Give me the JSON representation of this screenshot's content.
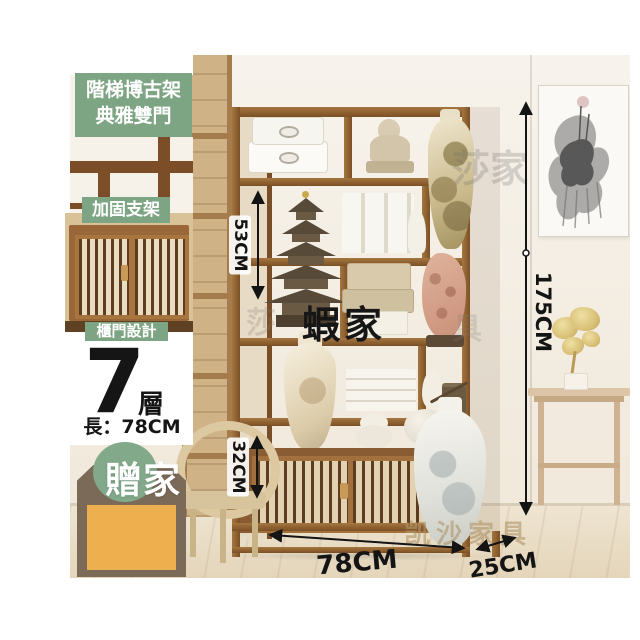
{
  "badges": {
    "title_line1": "階梯博古架",
    "title_line2": "典雅雙門",
    "feature_top": "加固支架",
    "feature_bottom": "櫃門設計",
    "tier_count": "7",
    "tier_unit": "層",
    "length_label": "長：78CM",
    "gift_text": "贈家"
  },
  "dimensions": {
    "upper_height": "53CM",
    "cabinet_height": "32CM",
    "total_height": "175CM",
    "width": "78CM",
    "depth": "25CM"
  },
  "watermarks": {
    "center": "蝦家",
    "top_right": "莎家",
    "mid_left": "莎",
    "mid_right": "具",
    "bottom": "凯沙家具"
  },
  "colors": {
    "label_green": "#7ea583",
    "tag_brown": "#7b6a58",
    "swatch_yellow": "#eeb04f",
    "shelf_wood": "#8a5c34",
    "annotation_black": "#141414"
  }
}
